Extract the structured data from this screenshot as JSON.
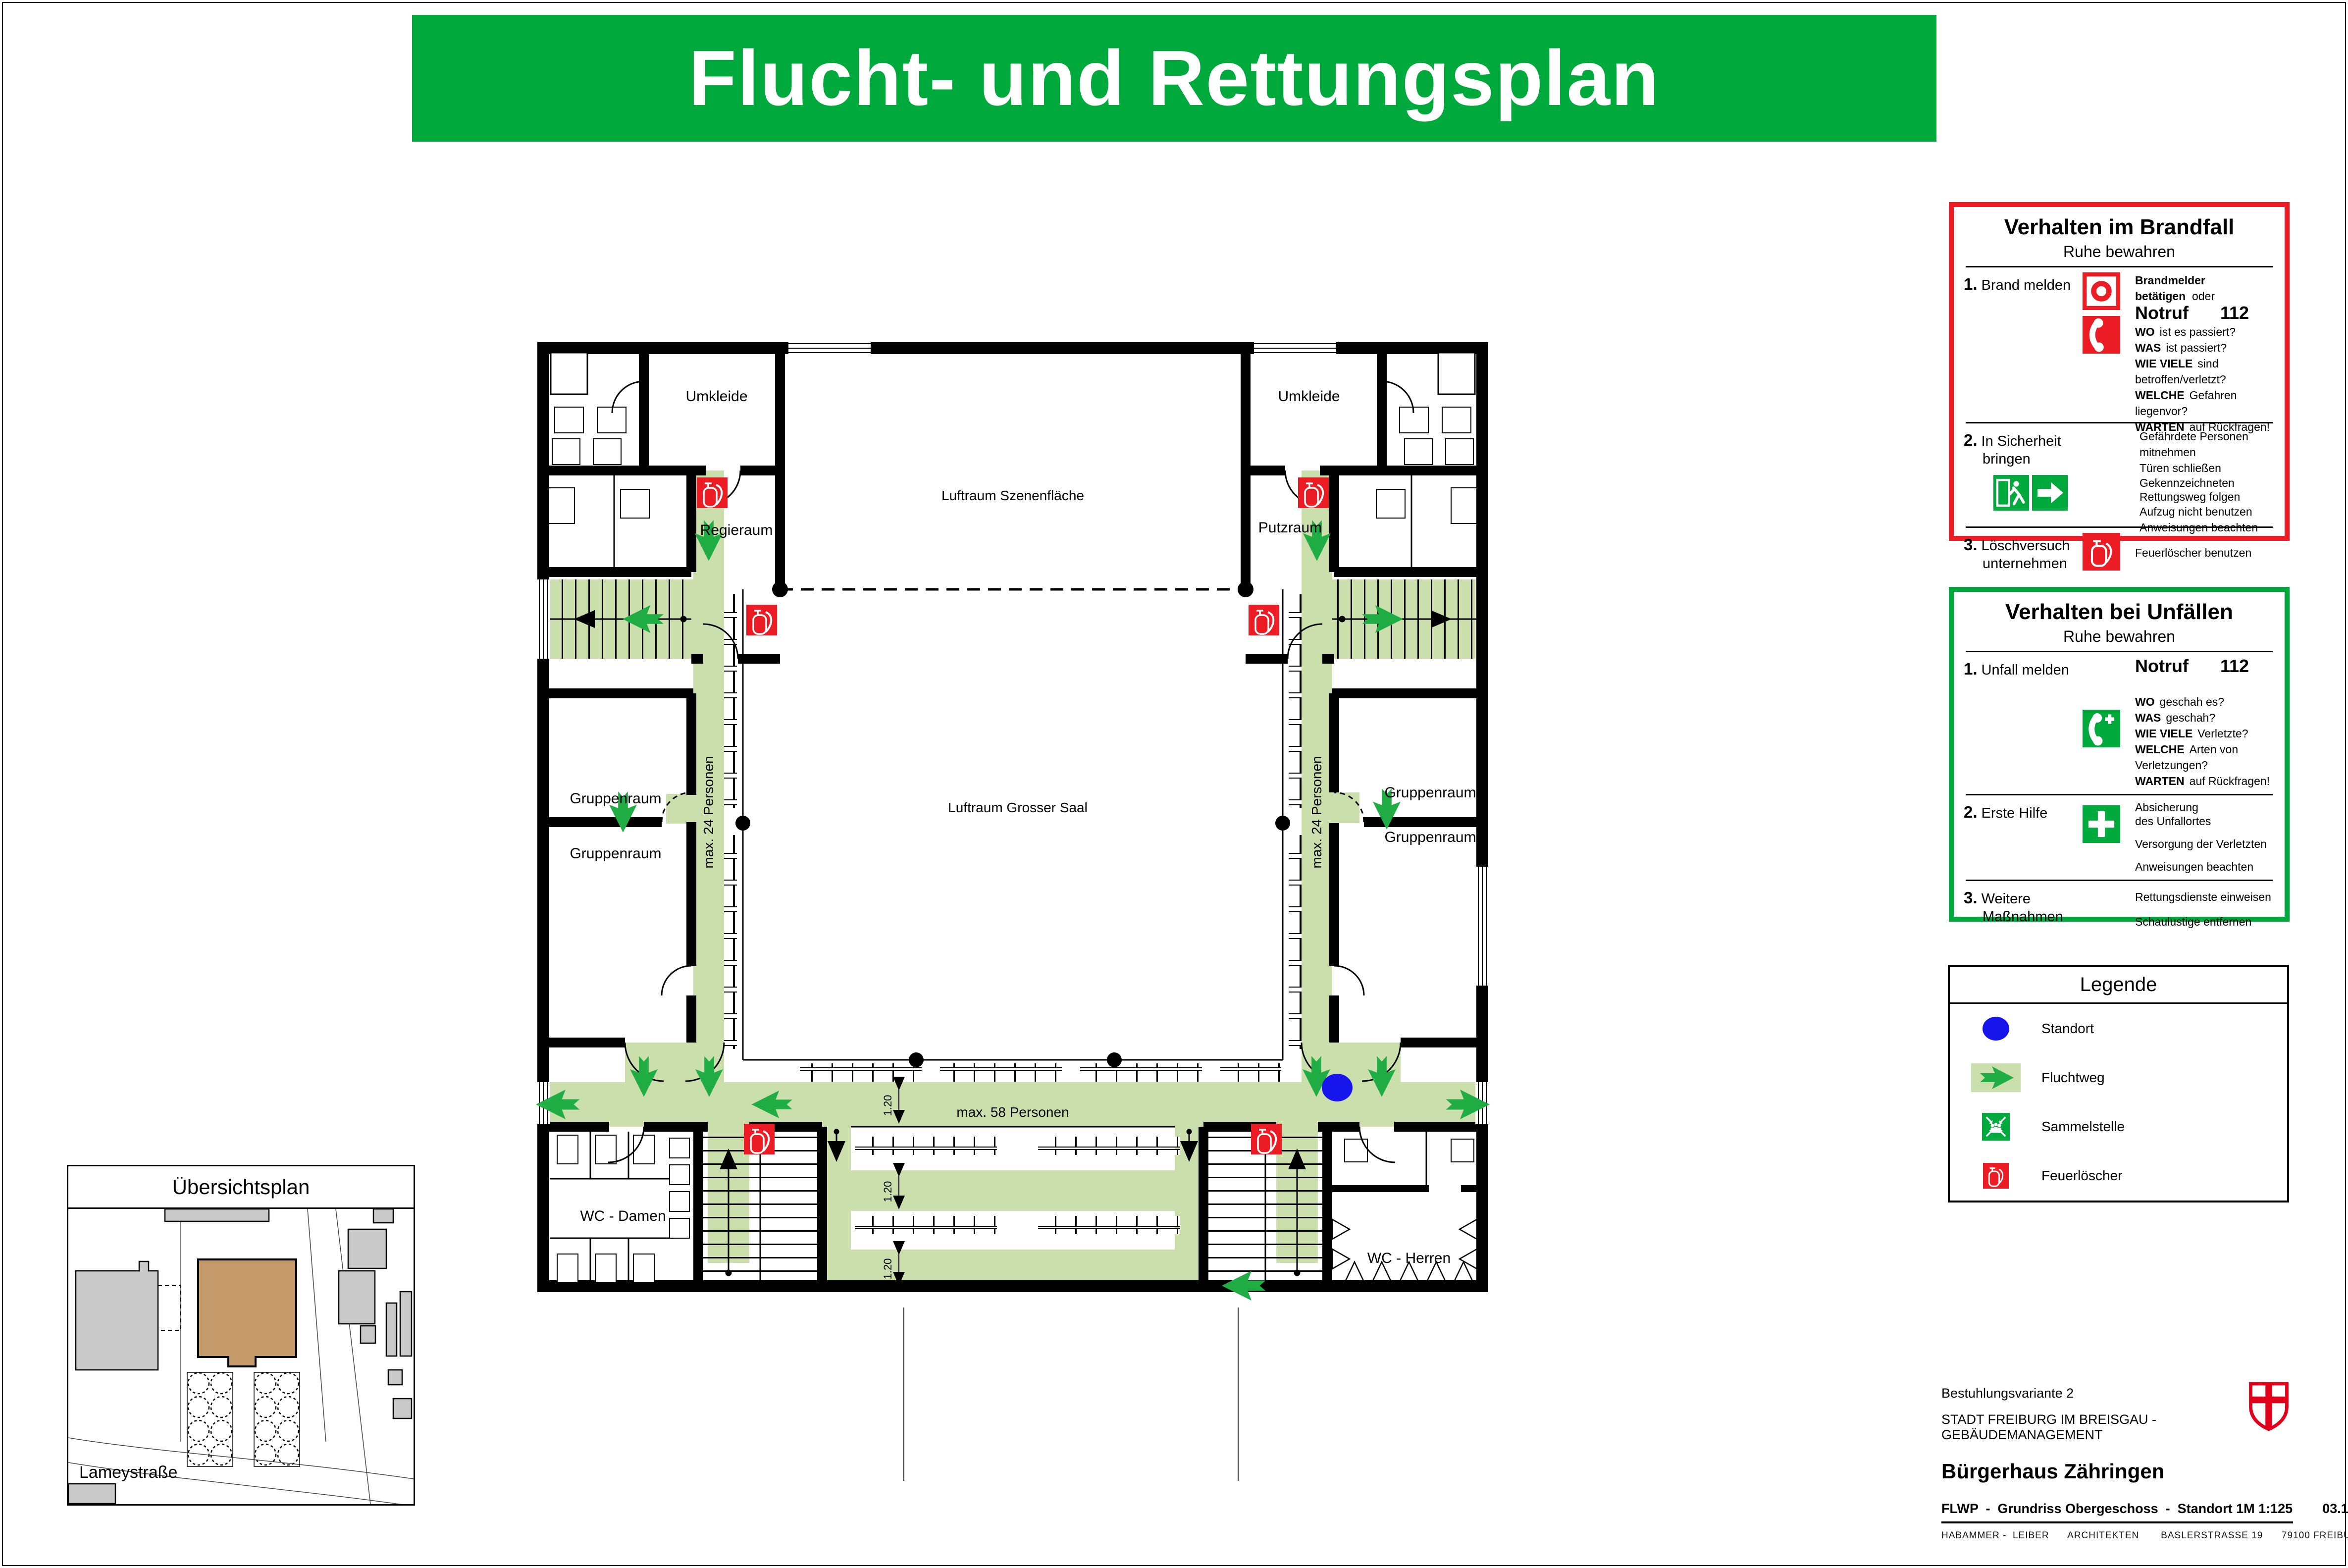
{
  "header": {
    "title": "Flucht- und Rettungsplan"
  },
  "colors": {
    "accent_green": "#00A93C",
    "route_green": "#CBDFAD",
    "arrow_green": "#1FAD44",
    "alert_red": "#EC1C24",
    "standort_blue": "#1616EC",
    "building_tan": "#C59A6B"
  },
  "fire_notice": {
    "title": "Verhalten im Brandfall",
    "subtitle": "Ruhe bewahren",
    "step1_num": "1.",
    "step1_label": "Brand melden",
    "step1_line1_bold": "Brandmelder betätigen",
    "step1_line1_tail": "oder",
    "notruf": "Notruf",
    "notruf_number": "112",
    "q1_key": "WO",
    "q1_text": "ist es passiert?",
    "q2_key": "WAS",
    "q2_text": "ist passiert?",
    "q3_key": "WIE VIELE",
    "q3_text": "sind betroffen/verletzt?",
    "q4_key": "WELCHE",
    "q4_text": "Gefahren liegenvor?",
    "q5_key": "WARTEN",
    "q5_text": "auf Rückfragen!",
    "step2_num": "2.",
    "step2_label1": "In Sicherheit",
    "step2_label2": "bringen",
    "step2_l1": "Gefährdete Personen mitnehmen",
    "step2_l2": "Türen schließen",
    "step2_l3": "Gekennzeichneten",
    "step2_l4": "Rettungsweg folgen",
    "step2_l5": "Aufzug nicht benutzen",
    "step2_l6": "Anweisungen beachten",
    "step3_num": "3.",
    "step3_label1": "Löschversuch",
    "step3_label2": "unternehmen",
    "step3_l1": "Feuerlöscher benutzen"
  },
  "accident_notice": {
    "title": "Verhalten bei Unfällen",
    "subtitle": "Ruhe bewahren",
    "step1_num": "1.",
    "step1_label": "Unfall melden",
    "notruf": "Notruf",
    "notruf_number": "112",
    "q1_key": "WO",
    "q1_text": "geschah es?",
    "q2_key": "WAS",
    "q2_text": "geschah?",
    "q3_key": "WIE VIELE",
    "q3_text": "Verletzte?",
    "q4_key": "WELCHE",
    "q4_text": "Arten von Verletzungen?",
    "q5_key": "WARTEN",
    "q5_text": "auf Rückfragen!",
    "step2_num": "2.",
    "step2_label": "Erste Hilfe",
    "step2_l1": "Absicherung",
    "step2_l2": "des Unfallortes",
    "step2_l3": "Versorgung der Verletzten",
    "step2_l4": "Anweisungen beachten",
    "step3_num": "3.",
    "step3_label1": "Weitere",
    "step3_label2": "Maßnahmen",
    "step3_l1": "Rettungsdienste einweisen",
    "step3_l2": "Schaulustige entfernen"
  },
  "legend": {
    "title": "Legende",
    "item1": "Standort",
    "item2": "Fluchtweg",
    "item3": "Sammelstelle",
    "item4": "Feuerlöscher"
  },
  "overview": {
    "title": "Übersichtsplan",
    "street": "Lameystraße"
  },
  "plan": {
    "room_umkleide": "Umkleide",
    "room_regieraum": "Regieraum",
    "room_putzraum": "Putzraum",
    "room_gruppenraum": "Gruppenraum",
    "room_wc_damen": "WC - Damen",
    "room_wc_herren": "WC - Herren",
    "area_szene": "Luftraum Szenenfläche",
    "area_saal": "Luftraum Grosser Saal",
    "cap_side": "max. 24 Personen",
    "cap_bottom": "max. 58 Personen",
    "dim": "1.20"
  },
  "titleblock": {
    "variant": "Bestuhlungsvariante 2",
    "owner": "STADT FREIBURG IM BREISGAU  -  GEBÄUDEMANAGEMENT",
    "project": "Bürgerhaus Zähringen",
    "sheet": "FLWP  -  Grundriss Obergeschoss  -  Standort 1",
    "scale": "M 1:125",
    "date": "03.11.15",
    "firm": "HABAMMER -  LEIBER      ARCHITEKTEN       BASLERSTRASSE 19      79100 FREIBURG      0761 - 2115830"
  }
}
